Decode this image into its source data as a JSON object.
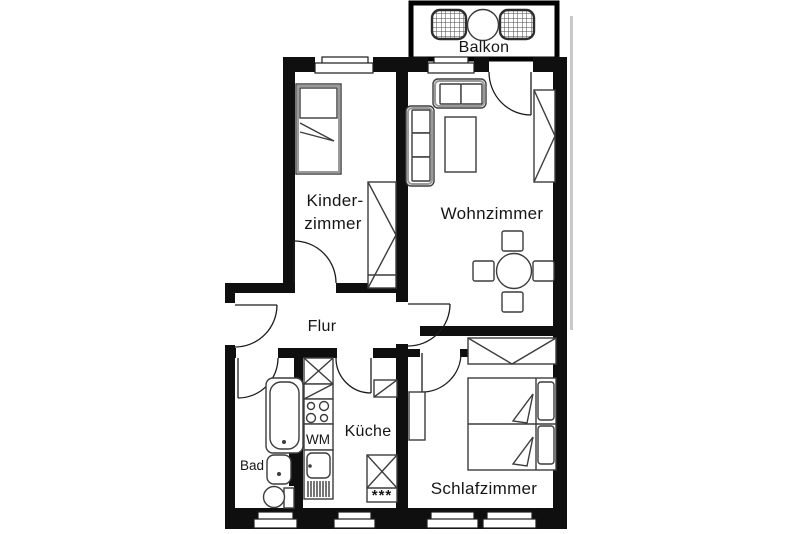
{
  "rooms": {
    "balkon": {
      "label": "Balkon"
    },
    "kinderzimmer": {
      "line1": "Kinder-",
      "line2": "zimmer"
    },
    "wohnzimmer": {
      "label": "Wohnzimmer"
    },
    "flur": {
      "label": "Flur"
    },
    "kueche": {
      "label": "Küche"
    },
    "bad": {
      "label": "Bad"
    },
    "schlafzimmer": {
      "label": "Schlafzimmer"
    }
  },
  "appliances": {
    "washing_machine": {
      "label": "WM"
    },
    "freezer_stars": {
      "label": "***"
    }
  },
  "colors": {
    "background": "#ffffff",
    "wall": "#0f0f0f",
    "furniture": "#3c3c3c",
    "detail": "#9a9a9a",
    "exterior_shadow": "#c8c8c8"
  }
}
